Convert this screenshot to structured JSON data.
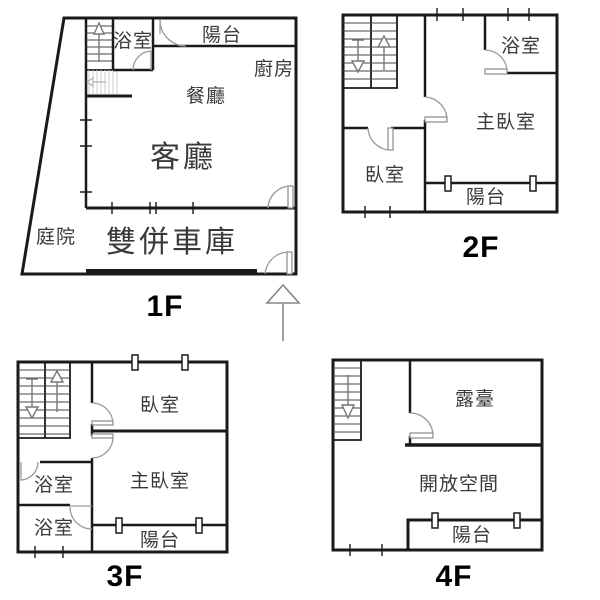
{
  "floors": [
    {
      "label": "1F",
      "rooms": {
        "balcony": "陽台",
        "bathroom": "浴室",
        "kitchen": "廚房",
        "dining": "餐廳",
        "living": "客廳",
        "courtyard": "庭院",
        "garage": "雙併車庫"
      }
    },
    {
      "label": "2F",
      "rooms": {
        "bathroom": "浴室",
        "master": "主臥室",
        "bedroom": "臥室",
        "balcony": "陽台"
      }
    },
    {
      "label": "3F",
      "rooms": {
        "bedroom": "臥室",
        "master": "主臥室",
        "bath_upper": "浴室",
        "bath_lower": "浴室",
        "balcony": "陽台"
      }
    },
    {
      "label": "4F",
      "rooms": {
        "terrace": "露臺",
        "open_space": "開放空間",
        "balcony": "陽台"
      }
    }
  ],
  "icons": {
    "stairs_up_arrow": "↑",
    "stairs_down_arrow": "↓",
    "under_stair_arrow": "←",
    "north_arrow": "↑"
  },
  "colors": {
    "background": "#ffffff",
    "wall": "#1a1a1a",
    "door_arc": "#9a9a9a",
    "stair_detail": "#777777",
    "hatch": "#cccccc",
    "text": "#3a3a3a",
    "floor_label": "#000000"
  }
}
